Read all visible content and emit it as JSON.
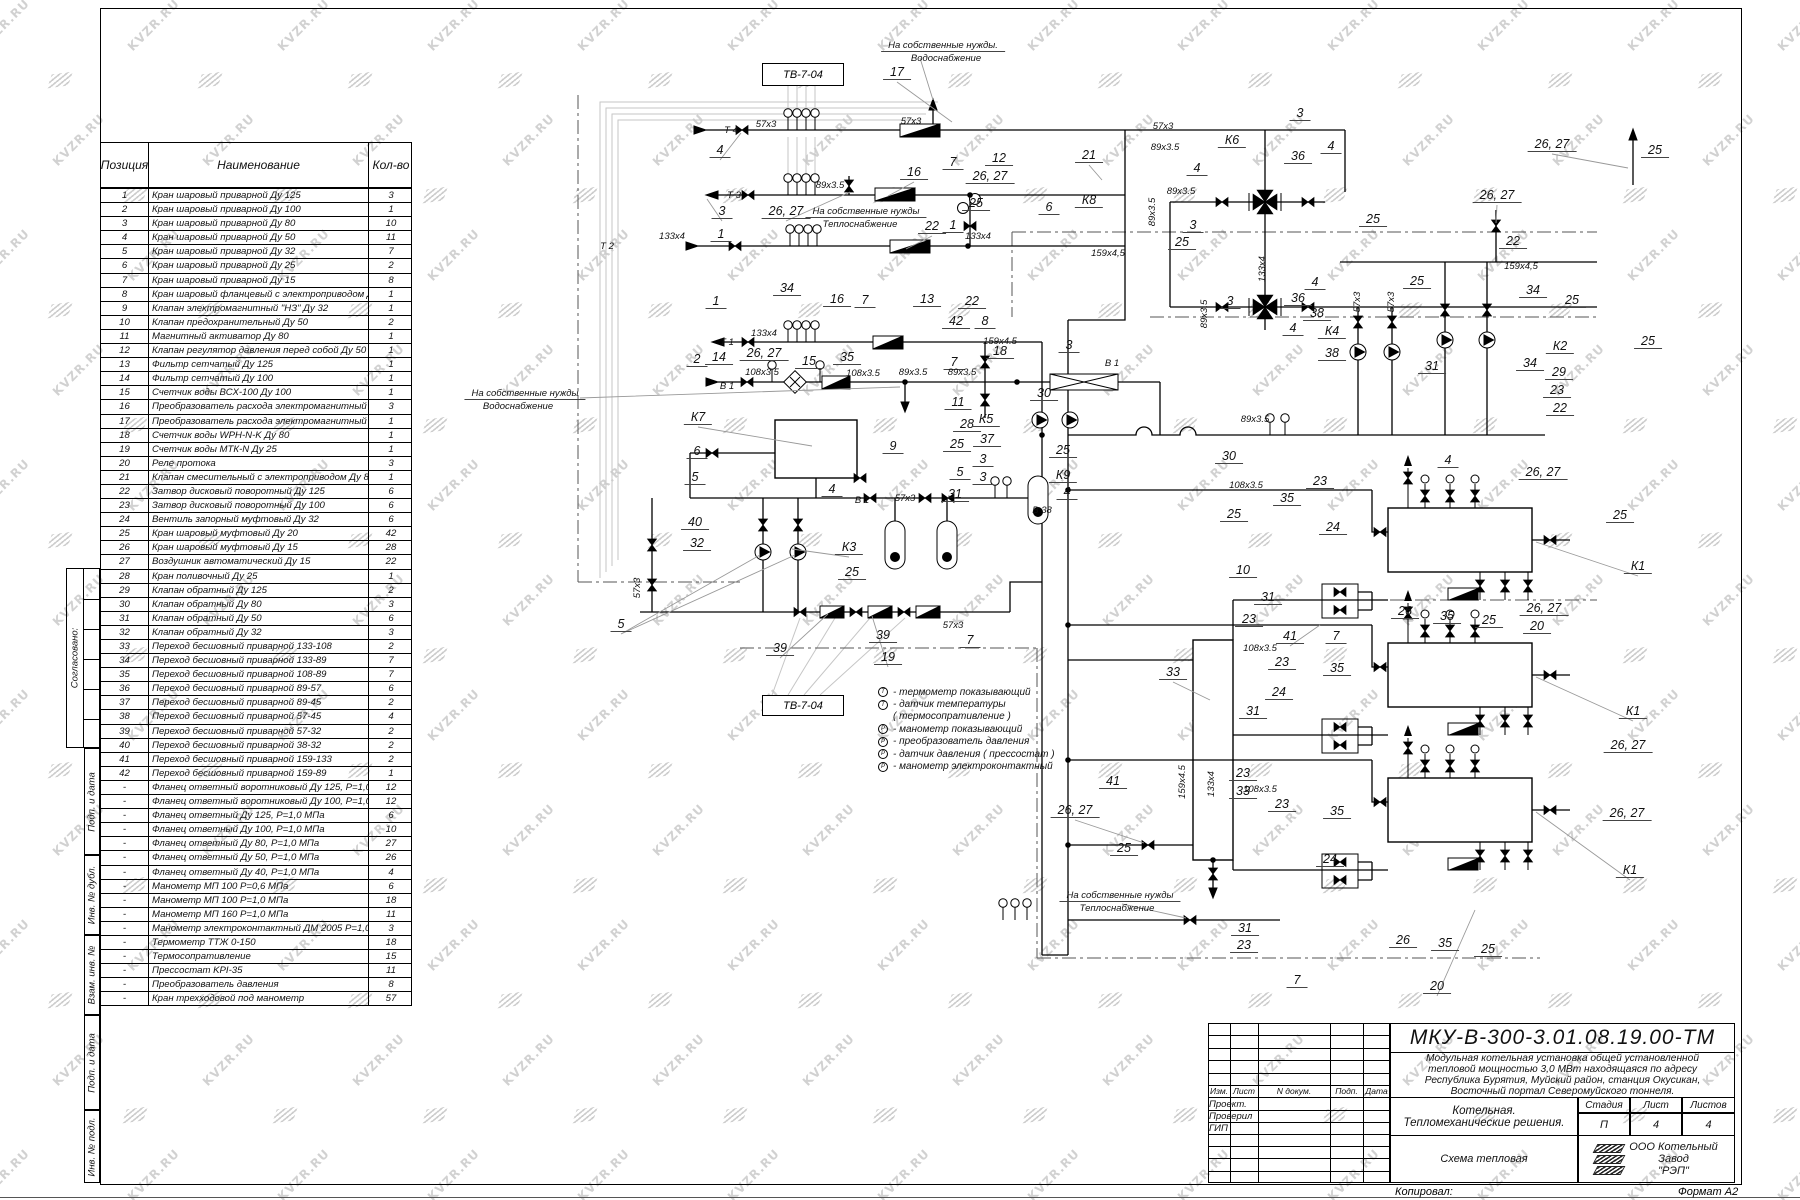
{
  "watermark": {
    "text": "KVZR.RU"
  },
  "frame": {
    "left_stamps": [
      "Согласовано:",
      "Подп. и дата",
      "Инв. № дубл.",
      "Взам. инв. №",
      "Подп. и дата",
      "Инв. № подл."
    ]
  },
  "parts_table": {
    "headers": {
      "position": "Позиция",
      "name": "Наименование",
      "qty": "Кол-во"
    },
    "rows": [
      [
        "1",
        "Кран шаровый приварной Ду 125",
        "3"
      ],
      [
        "2",
        "Кран шаровый приварной Ду 100",
        "1"
      ],
      [
        "3",
        "Кран шаровый приварной Ду 80",
        "10"
      ],
      [
        "4",
        "Кран шаровый приварной Ду 50",
        "11"
      ],
      [
        "5",
        "Кран шаровый приварной Ду 32",
        "7"
      ],
      [
        "6",
        "Кран шаровый приварной Ду 25",
        "2"
      ],
      [
        "7",
        "Кран шаровый приварной Ду 15",
        "8"
      ],
      [
        "8",
        "Кран шаровый фланцевый с электроприводом Ду 50",
        "1"
      ],
      [
        "9",
        "Клапан электромагнитный \"НЗ\" Ду 32",
        "1"
      ],
      [
        "10",
        "Клапан предохранительный Ду 50",
        "2"
      ],
      [
        "11",
        "Магнитный активатор Ду 80",
        "1"
      ],
      [
        "12",
        "Клапан регулятор давления перед собой Ду 50",
        "1"
      ],
      [
        "13",
        "Фильтр сетчатый Ду 125",
        "1"
      ],
      [
        "14",
        "Фильтр сетчатый Ду 100",
        "1"
      ],
      [
        "15",
        "Счетчик  воды ВСХ-100  Ду 100",
        "1"
      ],
      [
        "16",
        "Преобразователь расхода электромагнитный Ду 80",
        "3"
      ],
      [
        "17",
        "Преобразователь расхода электромагнитный Ду 50",
        "1"
      ],
      [
        "18",
        "Счетчик  воды  WPH-N-K  Ду 80",
        "1"
      ],
      [
        "19",
        "Счетчик  воды  МТК-N  Ду 25",
        "1"
      ],
      [
        "20",
        "Реле протока",
        "3"
      ],
      [
        "21",
        "Клапан смесительный с электроприводом Ду 80",
        "1"
      ],
      [
        "22",
        "Затвор дисковый поворотный Ду 125",
        "6"
      ],
      [
        "23",
        "Затвор дисковый поворотный Ду 100",
        "6"
      ],
      [
        "24",
        "Вентиль запорный муфтовый  Ду 32",
        "6"
      ],
      [
        "25",
        "Кран шаровый муфтовый Ду 20",
        "42"
      ],
      [
        "26",
        "Кран шаровый муфтовый Ду 15",
        "28"
      ],
      [
        "27",
        "Воздушник автоматический Ду 15",
        "22"
      ],
      [
        "28",
        "Кран поливочный Ду 25",
        "1"
      ],
      [
        "29",
        "Клапан обратный Ду 125",
        "2"
      ],
      [
        "30",
        "Клапан обратный Ду 80",
        "3"
      ],
      [
        "31",
        "Клапан обратный Ду 50",
        "6"
      ],
      [
        "32",
        "Клапан обратный Ду 32",
        "3"
      ],
      [
        "33",
        "Переход бесшовный приварной  133-108",
        "2"
      ],
      [
        "34",
        "Переход бесшовный приварной  133-89",
        "7"
      ],
      [
        "35",
        "Переход бесшовный приварной  108-89",
        "7"
      ],
      [
        "36",
        "Переход бесшовный приварной  89-57",
        "6"
      ],
      [
        "37",
        "Переход бесшовный приварной  89-45",
        "2"
      ],
      [
        "38",
        "Переход бесшовный приварной  57-45",
        "4"
      ],
      [
        "39",
        "Переход бесшовный приварной  57-32",
        "2"
      ],
      [
        "40",
        "Переход бесшовный приварной  38-32",
        "2"
      ],
      [
        "41",
        "Переход бесшовный приварной  159-133",
        "2"
      ],
      [
        "42",
        "Переход бесшовный приварной  159-89",
        "1"
      ],
      [
        "-",
        "Фланец ответный воротниковый Ду 125,  P=1,0  МПа",
        "12"
      ],
      [
        "-",
        "Фланец ответный воротниковый Ду 100,  P=1,0  МПа",
        "12"
      ],
      [
        "-",
        "Фланец ответный Ду 125,  P=1,0  МПа",
        "6"
      ],
      [
        "-",
        "Фланец ответный Ду 100,  P=1,0  МПа",
        "10"
      ],
      [
        "-",
        "Фланец ответный Ду 80,  P=1,0  МПа",
        "27"
      ],
      [
        "-",
        "Фланец ответный Ду 50,  P=1,0  МПа",
        "26"
      ],
      [
        "-",
        "Фланец ответный Ду 40,  P=1,0  МПа",
        "4"
      ],
      [
        "-",
        "Манометр МП 100  P=0,6  МПа",
        "6"
      ],
      [
        "-",
        "Манометр МП 100  P=1,0  МПа",
        "18"
      ],
      [
        "-",
        "Манометр МП 160  P=1,0  МПа",
        "11"
      ],
      [
        "-",
        "Манометр электроконтактный ДМ 2005  P=1,0  МПа",
        "3"
      ],
      [
        "-",
        "Термометр ТТЖ  0-150",
        "18"
      ],
      [
        "-",
        "Термосопративление",
        "15"
      ],
      [
        "-",
        "Прессостат  KPI-35",
        "11"
      ],
      [
        "-",
        "Преобразователь давления",
        "8"
      ],
      [
        "-",
        "Кран трехходовой под манометр",
        "57"
      ]
    ]
  },
  "tv_boxes": {
    "top": "ТВ-7-04",
    "bottom": "ТВ-7-04"
  },
  "legend": {
    "items": [
      {
        "sym": "Т",
        "label": "-  термометр показывающий"
      },
      {
        "sym": "Т",
        "label": "-  датчик температуры"
      },
      {
        "sym": "",
        "label": "( термосопративление )"
      },
      {
        "sym": "Р",
        "label": "-  манометр показывающий"
      },
      {
        "sym": "Р",
        "label": "-  преобразователь давления"
      },
      {
        "sym": "Р",
        "label": "-  датчик давления ( прессостат )"
      },
      {
        "sym": "Р",
        "label": "-  манометр электроконтактный"
      }
    ]
  },
  "schematic": {
    "labels": [
      [
        "17",
        897,
        80,
        "u"
      ],
      [
        "На собственные нужды.",
        943,
        52,
        "su"
      ],
      [
        "Водоснабжение",
        946,
        64,
        "s"
      ],
      [
        "Т 4",
        731,
        136,
        "s"
      ],
      [
        "57x3",
        766,
        130,
        "s"
      ],
      [
        "4",
        720,
        158,
        "u"
      ],
      [
        "57x3",
        911,
        127,
        "s"
      ],
      [
        "16",
        914,
        180,
        "u"
      ],
      [
        "7",
        953,
        170,
        "u"
      ],
      [
        "12",
        999,
        166,
        "u"
      ],
      [
        "26, 27",
        990,
        184,
        "u"
      ],
      [
        "Т 3",
        734,
        201,
        "s"
      ],
      [
        "89x3.5",
        830,
        191,
        "s"
      ],
      [
        "3",
        722,
        219,
        "u"
      ],
      [
        "26, 27",
        786,
        219,
        "u"
      ],
      [
        "На собственные нужды",
        866,
        218,
        "su"
      ],
      [
        "Теплоснабжение",
        860,
        230,
        "s"
      ],
      [
        "22",
        932,
        234,
        "u"
      ],
      [
        "25",
        976,
        211,
        "u"
      ],
      [
        "1",
        953,
        233,
        "u"
      ],
      [
        "133x4",
        978,
        242,
        "s"
      ],
      [
        "21",
        1089,
        163,
        "u"
      ],
      [
        "К8",
        1089,
        208,
        "u"
      ],
      [
        "6",
        1049,
        215,
        "u"
      ],
      [
        "159x4,5",
        1108,
        259,
        "s"
      ],
      [
        "1",
        721,
        242,
        "u"
      ],
      [
        "Т 2",
        607,
        252,
        "s"
      ],
      [
        "133x4",
        672,
        242,
        "s"
      ],
      [
        "34",
        787,
        296,
        "u"
      ],
      [
        "16",
        837,
        307,
        "u"
      ],
      [
        "7",
        865,
        308,
        "u"
      ],
      [
        "13",
        927,
        307,
        "u"
      ],
      [
        "22",
        972,
        309,
        "u"
      ],
      [
        "42",
        956,
        329,
        "u"
      ],
      [
        "8",
        985,
        329,
        "u"
      ],
      [
        "159х4.5",
        1000,
        347,
        "s"
      ],
      [
        "1",
        716,
        309,
        "u"
      ],
      [
        "Т 1",
        727,
        348,
        "s"
      ],
      [
        "133x4",
        764,
        339,
        "s"
      ],
      [
        "26, 27",
        764,
        361,
        "u"
      ],
      [
        "2",
        697,
        367,
        "u"
      ],
      [
        "14",
        719,
        365,
        "u"
      ],
      [
        "15",
        809,
        369,
        "u"
      ],
      [
        "35",
        847,
        365,
        "u"
      ],
      [
        "7",
        954,
        370,
        "u"
      ],
      [
        "18",
        1000,
        359,
        "u"
      ],
      [
        "3",
        1069,
        353,
        "u"
      ],
      [
        "В 1",
        727,
        392,
        "s"
      ],
      [
        "108x3.5",
        762,
        378,
        "s"
      ],
      [
        "108x3.5",
        863,
        379,
        "s"
      ],
      [
        "89x3.5",
        913,
        378,
        "s"
      ],
      [
        "89x3.5",
        962,
        378,
        "s"
      ],
      [
        "В 1",
        1112,
        369,
        "s"
      ],
      [
        "На собственные нужды",
        525,
        400,
        "su"
      ],
      [
        "Водоснабжение",
        518,
        412,
        "s"
      ],
      [
        "11",
        958,
        410,
        "u"
      ],
      [
        "28",
        967,
        432,
        "u"
      ],
      [
        "25",
        957,
        452,
        "u"
      ],
      [
        "К7",
        698,
        425,
        "u"
      ],
      [
        "9",
        893,
        454,
        "u"
      ],
      [
        "5",
        960,
        480,
        "u"
      ],
      [
        "31",
        955,
        502,
        "u"
      ],
      [
        "6",
        697,
        459,
        "u"
      ],
      [
        "5",
        695,
        485,
        "u"
      ],
      [
        "4",
        832,
        497,
        "u"
      ],
      [
        "В 1",
        862,
        506,
        "s"
      ],
      [
        "57x3",
        905,
        504,
        "s"
      ],
      [
        "40",
        695,
        530,
        "u"
      ],
      [
        "32",
        697,
        551,
        "u"
      ],
      [
        "К3",
        849,
        555,
        "u"
      ],
      [
        "25",
        852,
        580,
        "u"
      ],
      [
        "К5",
        986,
        427,
        "u"
      ],
      [
        "37",
        987,
        447,
        "u"
      ],
      [
        "3",
        983,
        467,
        "u"
      ],
      [
        "3",
        983,
        485,
        "u"
      ],
      [
        "30",
        1044,
        401,
        "u"
      ],
      [
        "К9",
        1063,
        483,
        "u"
      ],
      [
        "25",
        1063,
        458,
        "u"
      ],
      [
        "4",
        1067,
        500,
        "u"
      ],
      [
        "В 38",
        1042,
        516,
        "s"
      ],
      [
        "57x3",
        643,
        588,
        "rs"
      ],
      [
        "5",
        621,
        632,
        "u"
      ],
      [
        "39",
        780,
        656,
        "u"
      ],
      [
        "39",
        883,
        643,
        "u"
      ],
      [
        "19",
        888,
        665,
        "u"
      ],
      [
        "7",
        970,
        648,
        "u"
      ],
      [
        "57x3",
        953,
        631,
        "s"
      ],
      [
        "3",
        1300,
        121,
        "u"
      ],
      [
        "К6",
        1232,
        148,
        "u"
      ],
      [
        "36",
        1298,
        164,
        "u"
      ],
      [
        "4",
        1331,
        154,
        "u"
      ],
      [
        "4",
        1197,
        176,
        "u"
      ],
      [
        "57x3",
        1163,
        132,
        "s"
      ],
      [
        "89x3.5",
        1165,
        153,
        "s"
      ],
      [
        "89x3.5",
        1181,
        197,
        "s"
      ],
      [
        "89x3.5",
        1158,
        212,
        "rs"
      ],
      [
        "26, 27",
        1497,
        203,
        "u"
      ],
      [
        "26, 27",
        1552,
        152,
        "u"
      ],
      [
        "25",
        1655,
        158,
        "u"
      ],
      [
        "25",
        1373,
        227,
        "u"
      ],
      [
        "3",
        1193,
        233,
        "u"
      ],
      [
        "25",
        1182,
        250,
        "u"
      ],
      [
        "22",
        1513,
        249,
        "u"
      ],
      [
        "159x4,5",
        1521,
        272,
        "s"
      ],
      [
        "25",
        1417,
        289,
        "u"
      ],
      [
        "34",
        1533,
        298,
        "u"
      ],
      [
        "25",
        1572,
        308,
        "u"
      ],
      [
        "4",
        1315,
        290,
        "u"
      ],
      [
        "36",
        1298,
        306,
        "u"
      ],
      [
        "38",
        1317,
        321,
        "u"
      ],
      [
        "3",
        1230,
        309,
        "u"
      ],
      [
        "К4",
        1332,
        339,
        "u"
      ],
      [
        "38",
        1332,
        361,
        "u"
      ],
      [
        "4",
        1293,
        336,
        "u"
      ],
      [
        "31",
        1432,
        374,
        "u"
      ],
      [
        "К2",
        1560,
        354,
        "u"
      ],
      [
        "34",
        1530,
        371,
        "u"
      ],
      [
        "29",
        1559,
        380,
        "u"
      ],
      [
        "23",
        1557,
        398,
        "u"
      ],
      [
        "22",
        1560,
        416,
        "u"
      ],
      [
        "25",
        1648,
        349,
        "u"
      ],
      [
        "133x4",
        1268,
        269,
        "rs"
      ],
      [
        "89x3.5",
        1210,
        314,
        "rs"
      ],
      [
        "57x3",
        1363,
        302,
        "rs"
      ],
      [
        "57x3",
        1397,
        302,
        "rs"
      ],
      [
        "30",
        1229,
        464,
        "u"
      ],
      [
        "89x3.5",
        1255,
        425,
        "s"
      ],
      [
        "108x3.5",
        1246,
        491,
        "s"
      ],
      [
        "23",
        1320,
        489,
        "u"
      ],
      [
        "35",
        1287,
        506,
        "u"
      ],
      [
        "25",
        1234,
        522,
        "u"
      ],
      [
        "24",
        1333,
        535,
        "u"
      ],
      [
        "4",
        1448,
        468,
        "u"
      ],
      [
        "26, 27",
        1543,
        480,
        "u"
      ],
      [
        "25",
        1620,
        523,
        "u"
      ],
      [
        "К1",
        1638,
        574,
        "u"
      ],
      [
        "10",
        1243,
        578,
        "u"
      ],
      [
        "31",
        1268,
        605,
        "u"
      ],
      [
        "23",
        1249,
        627,
        "u"
      ],
      [
        "41",
        1290,
        644,
        "u"
      ],
      [
        "7",
        1336,
        644,
        "u"
      ],
      [
        "26",
        1405,
        619,
        "u"
      ],
      [
        "35",
        1447,
        624,
        "u"
      ],
      [
        "25",
        1489,
        628,
        "u"
      ],
      [
        "20",
        1537,
        634,
        "u"
      ],
      [
        "26, 27",
        1544,
        616,
        "u"
      ],
      [
        "33",
        1173,
        680,
        "u"
      ],
      [
        "108x3.5",
        1260,
        654,
        "s"
      ],
      [
        "23",
        1282,
        670,
        "u"
      ],
      [
        "35",
        1337,
        676,
        "u"
      ],
      [
        "24",
        1279,
        700,
        "u"
      ],
      [
        "31",
        1253,
        719,
        "u"
      ],
      [
        "К1",
        1633,
        719,
        "u"
      ],
      [
        "26, 27",
        1628,
        753,
        "u"
      ],
      [
        "41",
        1113,
        789,
        "u"
      ],
      [
        "26, 27",
        1075,
        818,
        "u"
      ],
      [
        "25",
        1124,
        856,
        "u"
      ],
      [
        "23",
        1243,
        781,
        "u"
      ],
      [
        "33",
        1243,
        799,
        "u"
      ],
      [
        "159х4.5",
        1188,
        782,
        "rs"
      ],
      [
        "133x4",
        1217,
        784,
        "rs"
      ],
      [
        "108x3.5",
        1260,
        795,
        "s"
      ],
      [
        "23",
        1282,
        812,
        "u"
      ],
      [
        "35",
        1337,
        819,
        "u"
      ],
      [
        "24",
        1330,
        867,
        "u"
      ],
      [
        "26, 27",
        1627,
        821,
        "u"
      ],
      [
        "К1",
        1630,
        878,
        "u"
      ],
      [
        "31",
        1245,
        936,
        "u"
      ],
      [
        "23",
        1244,
        953,
        "u"
      ],
      [
        "7",
        1297,
        988,
        "u"
      ],
      [
        "26",
        1403,
        948,
        "u"
      ],
      [
        "35",
        1445,
        951,
        "u"
      ],
      [
        "25",
        1488,
        957,
        "u"
      ],
      [
        "20",
        1437,
        994,
        "u"
      ],
      [
        "На собственные нужды",
        1120,
        902,
        "su"
      ],
      [
        "Теплоснабжение",
        1117,
        914,
        "s"
      ]
    ]
  },
  "title_block": {
    "doc_number": "МКУ-В-300-3.01.08.19.00-ТМ",
    "description_lines": [
      "Модульная котельная установка общей установленной",
      "тепловой мощностью 3,0 МВт  находящаяся по адресу",
      "Республика Бурятия, Муйский район, станция Окусикан,",
      "Восточный портал Северомуйского тоннеля."
    ],
    "object_line1": "Котельная.",
    "object_line2": "Тепломеханические решения.",
    "sheet_name": "Схема тепловая",
    "stage_label": "Стадия",
    "sheet_label": "Лист",
    "sheets_label": "Листов",
    "stage": "П",
    "sheet": "4",
    "sheets": "4",
    "company_lines": [
      "ООО Котельный",
      "Завод",
      "\"РЭП\""
    ],
    "header_cols": [
      "Изм.",
      "Лист",
      "N докум.",
      "Подп.",
      "Дата"
    ],
    "roles": [
      "Проект.",
      "Проверил",
      "ГИП"
    ]
  },
  "footer": {
    "copied": "Копировал:",
    "format": "Формат А2"
  }
}
